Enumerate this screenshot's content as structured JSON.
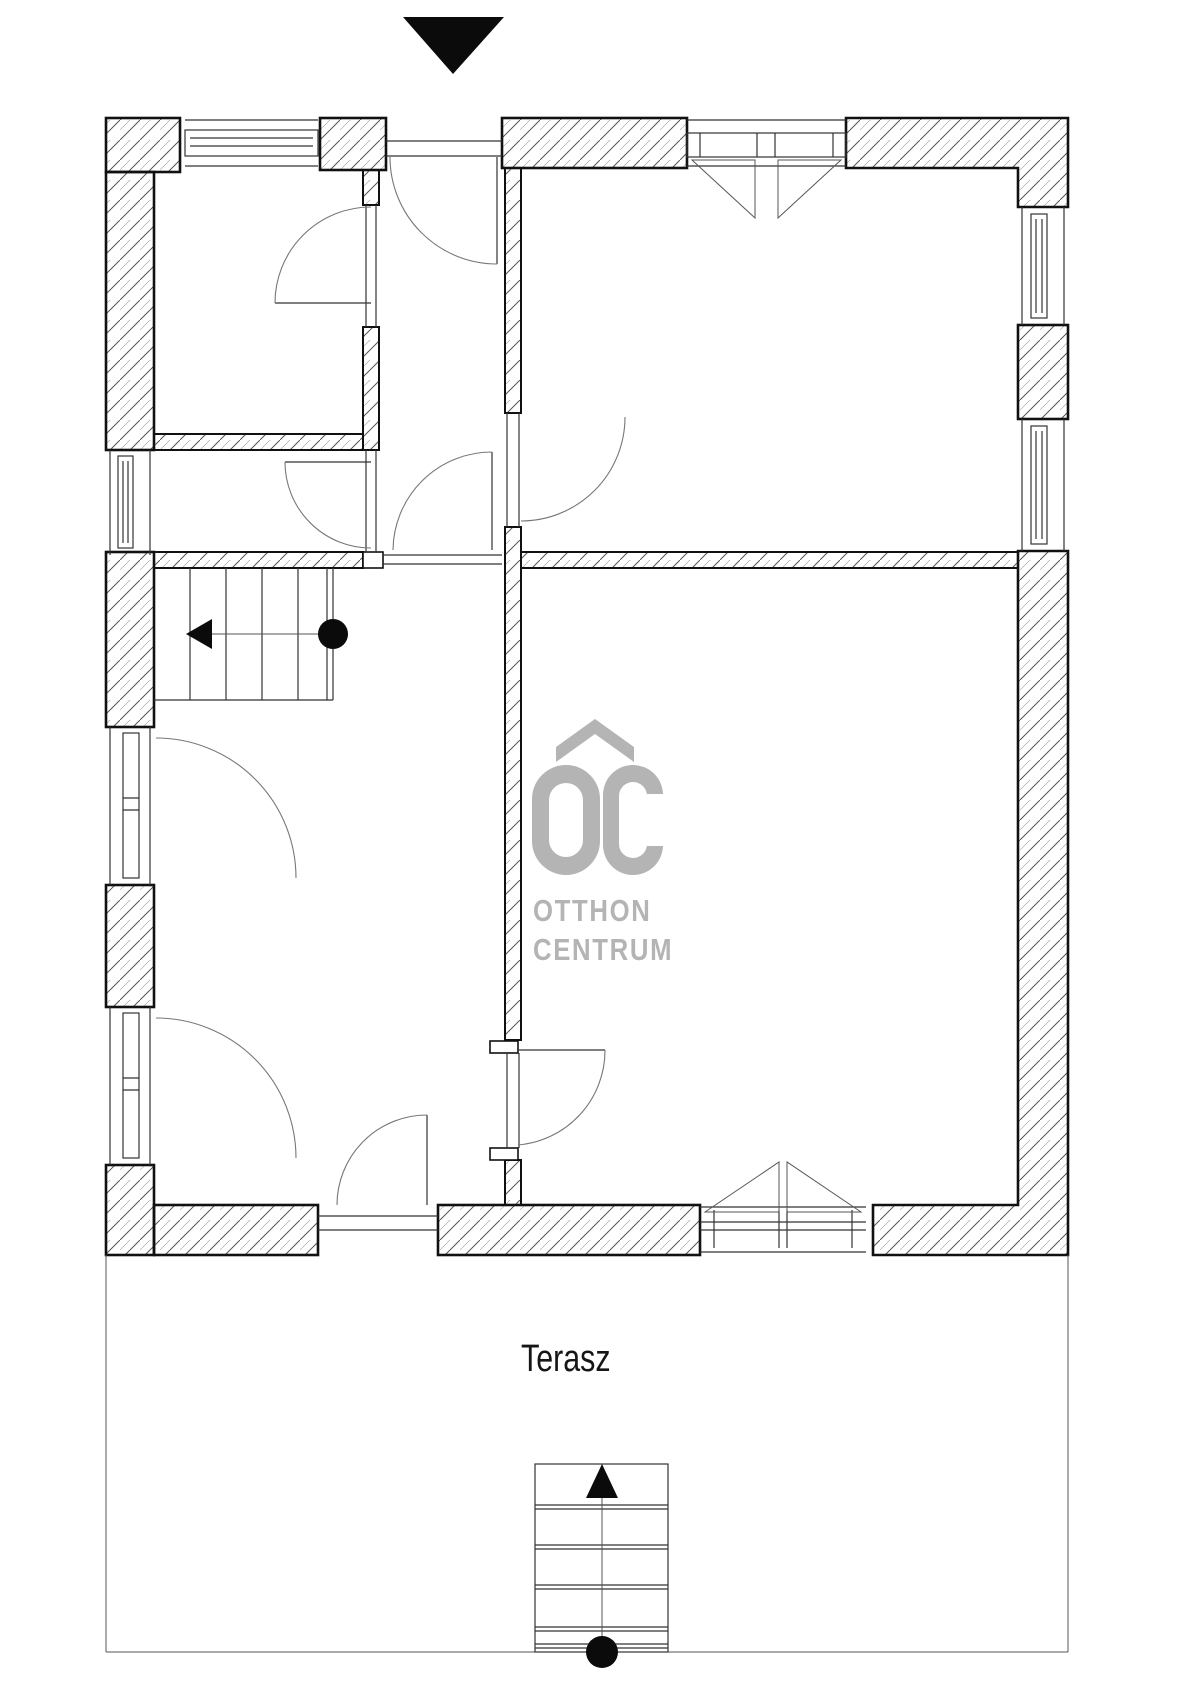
{
  "page": {
    "type": "floor-plan",
    "background": "#ffffff",
    "line_color": "#111111",
    "hatch_color": "#555555"
  },
  "labels": {
    "terrace": "Terasz"
  },
  "watermark": {
    "logo_text": "OC",
    "line1": "OTTHON",
    "line2": "CENTRUM",
    "color": "#b4b4b4"
  },
  "symbols": {
    "north_marker": "black triangle pointing down (top of plan)",
    "stair_up_marker": "black triangle pointing up (terrace stair)",
    "stair_direction": "arrow with start circle (interior stair, pointing left)"
  }
}
